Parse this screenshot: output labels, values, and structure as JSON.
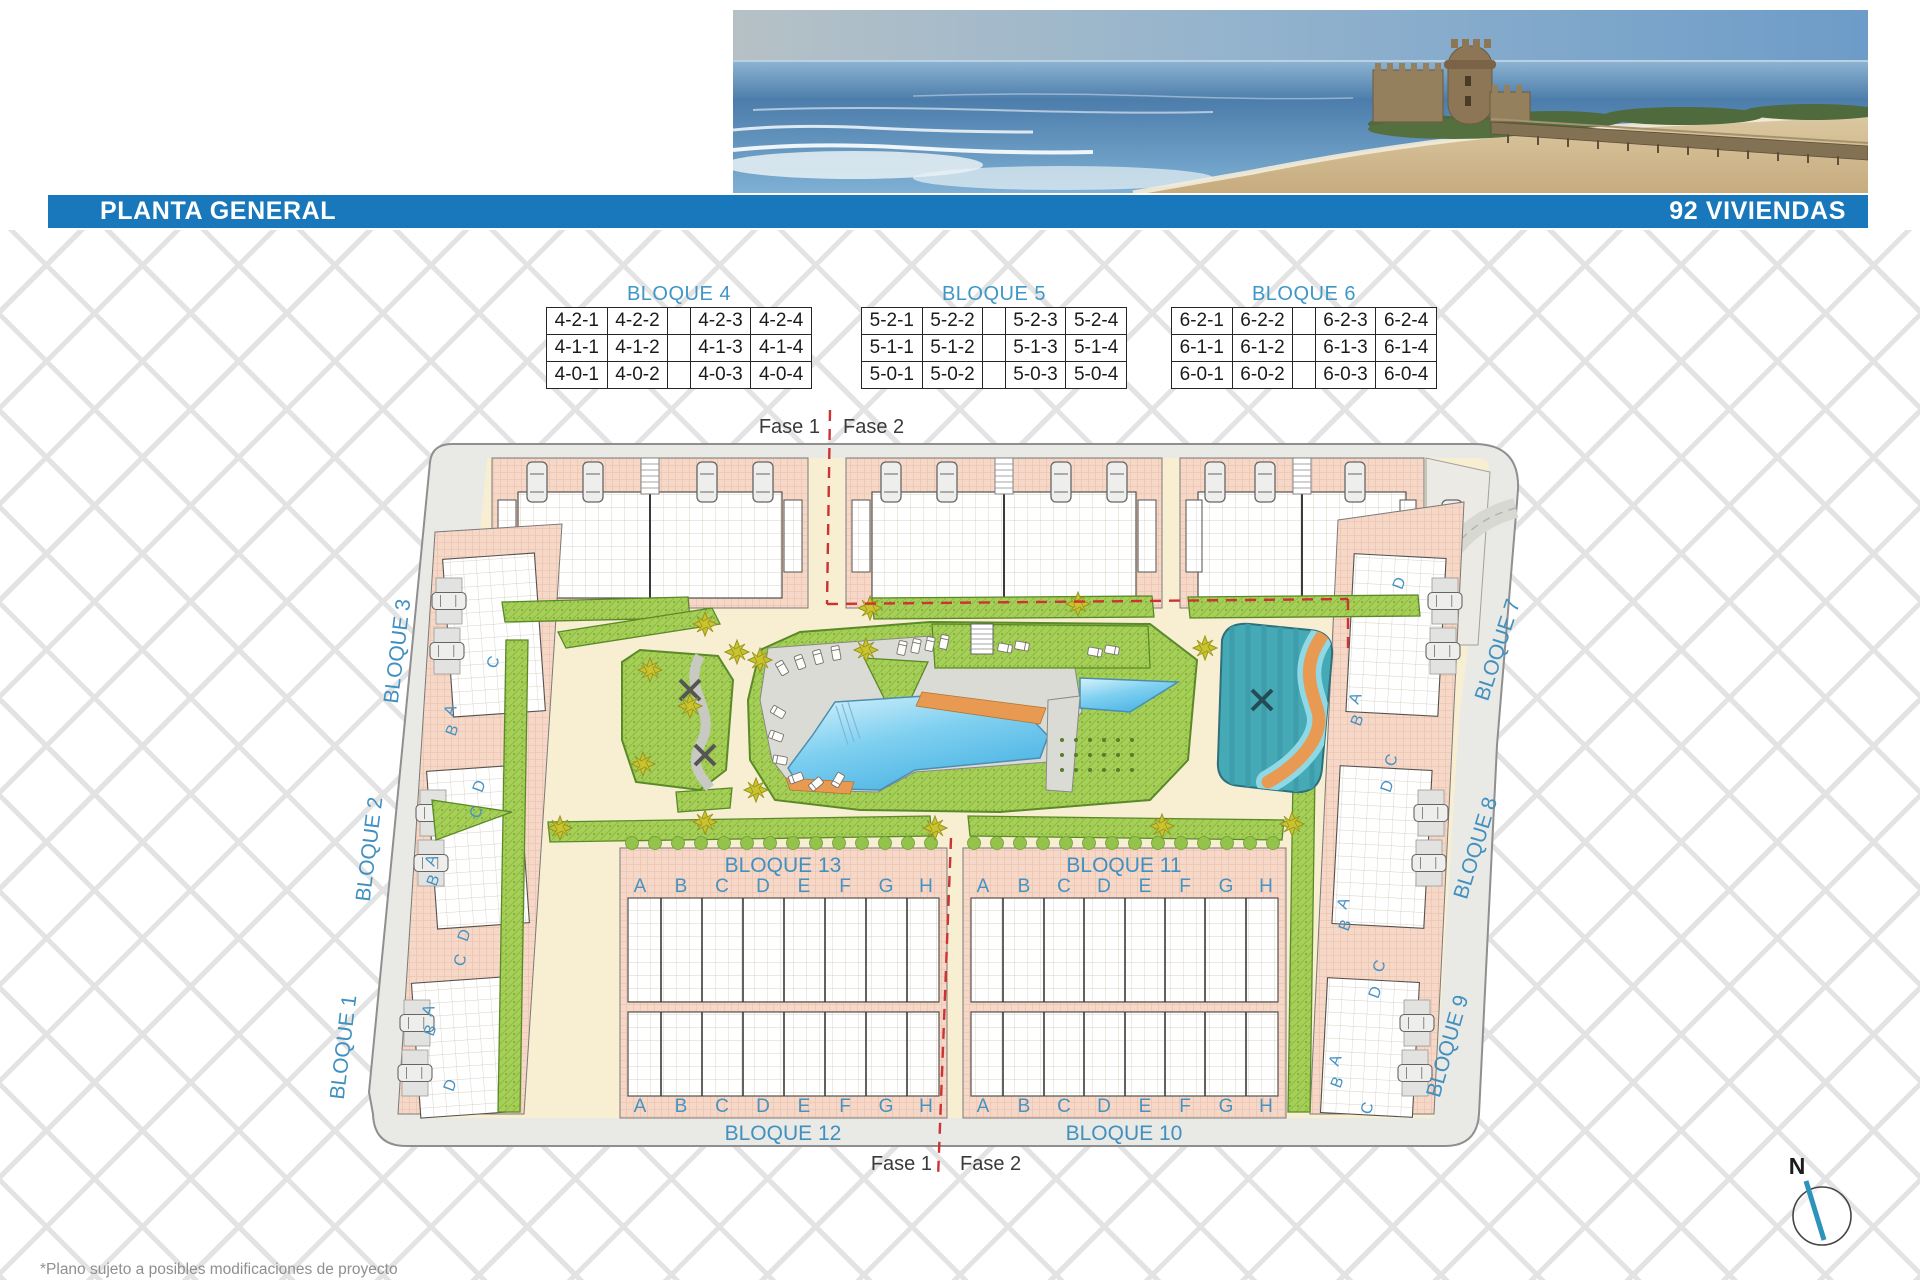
{
  "header": {
    "title": "PLANTA GENERAL",
    "units_label": "92 VIVIENDAS"
  },
  "tables": [
    {
      "title": "BLOQUE 4",
      "rows": [
        [
          "4-2-1",
          "4-2-2",
          "",
          "4-2-3",
          "4-2-4"
        ],
        [
          "4-1-1",
          "4-1-2",
          "",
          "4-1-3",
          "4-1-4"
        ],
        [
          "4-0-1",
          "4-0-2",
          "",
          "4-0-3",
          "4-0-4"
        ]
      ]
    },
    {
      "title": "BLOQUE 5",
      "rows": [
        [
          "5-2-1",
          "5-2-2",
          "",
          "5-2-3",
          "5-2-4"
        ],
        [
          "5-1-1",
          "5-1-2",
          "",
          "5-1-3",
          "5-1-4"
        ],
        [
          "5-0-1",
          "5-0-2",
          "",
          "5-0-3",
          "5-0-4"
        ]
      ]
    },
    {
      "title": "BLOQUE 6",
      "rows": [
        [
          "6-2-1",
          "6-2-2",
          "",
          "6-2-3",
          "6-2-4"
        ],
        [
          "6-1-1",
          "6-1-2",
          "",
          "6-1-3",
          "6-1-4"
        ],
        [
          "6-0-1",
          "6-0-2",
          "",
          "6-0-3",
          "6-0-4"
        ]
      ]
    }
  ],
  "phase": {
    "fase1": "Fase 1",
    "fase2": "Fase 2"
  },
  "plan": {
    "left_road_labels": [
      "BLOQUE 3",
      "BLOQUE 2",
      "BLOQUE 1"
    ],
    "right_road_labels": [
      "BLOQUE 7",
      "BLOQUE 8",
      "BLOQUE 9"
    ],
    "center_block_labels": [
      "BLOQUE 13",
      "BLOQUE 11"
    ],
    "bottom_road_labels": [
      "BLOQUE 12",
      "BLOQUE 10"
    ],
    "unit_letters": [
      "A",
      "B",
      "C",
      "D",
      "E",
      "F",
      "G",
      "H"
    ],
    "left_house_letters": [
      "C",
      "A",
      "B",
      "D",
      "C",
      "A",
      "B",
      "D",
      "C",
      "A",
      "B",
      "D"
    ],
    "right_house_letters": [
      "D",
      "A",
      "B",
      "C",
      "D",
      "A",
      "B",
      "C",
      "D",
      "A",
      "B",
      "C"
    ],
    "compass_label": "N"
  },
  "footnote": "*Plano sujeto a posibles modificaciones de proyecto",
  "colors": {
    "header_bar": "#1878bb",
    "section_label_blue": "#3e97c6",
    "phase_line_red": "#cc3333",
    "building_salmon": "#f6d8c8",
    "garden_green": "#a6cf58",
    "pool_blue": "#7fd0f0",
    "spa_teal": "#46aab6",
    "river_orange": "#e89a52",
    "road_gray": "#e9e9e6",
    "path_cream": "#f8efd3"
  }
}
